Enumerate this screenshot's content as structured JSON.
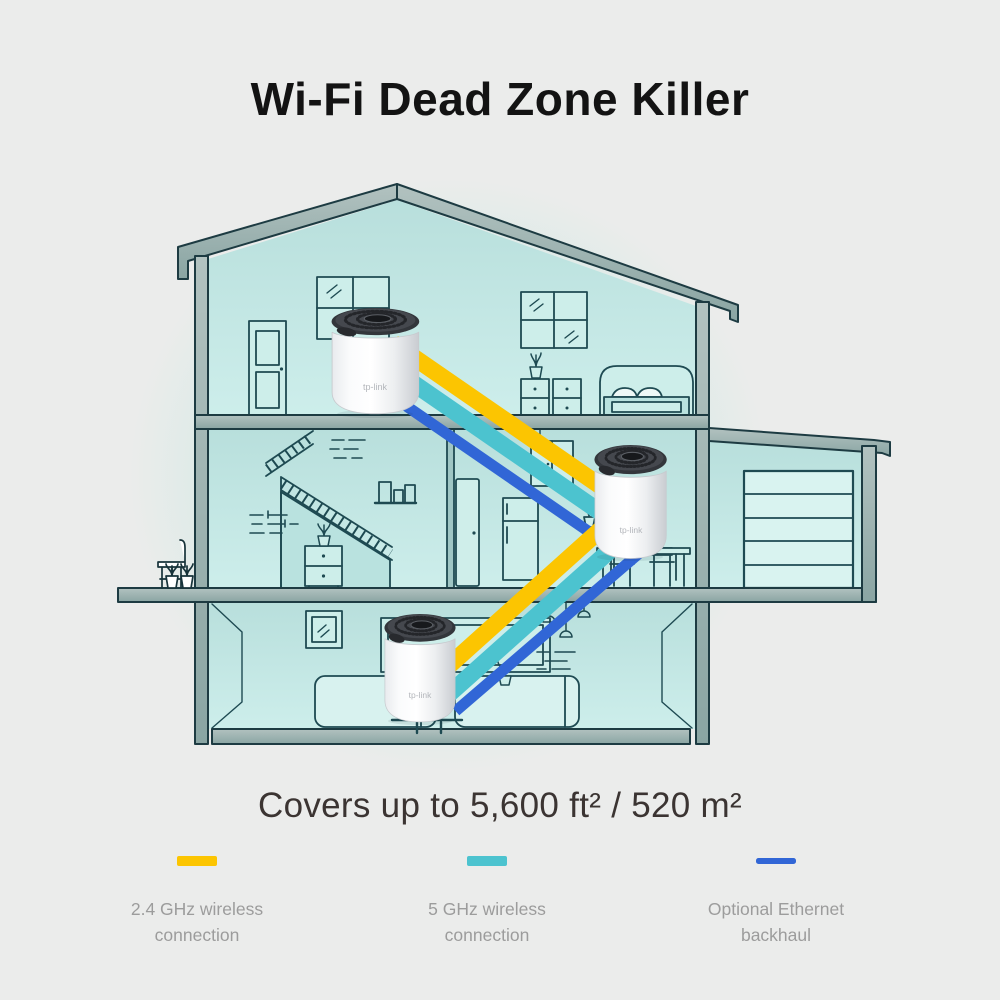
{
  "page": {
    "title": "Wi-Fi Dead Zone Killer",
    "coverage": "Covers up to 5,600 ft² / 520 m²"
  },
  "devices": {
    "brand": "tp-link",
    "count": 3,
    "units": [
      "attic-unit",
      "middle-floor-unit",
      "ground-floor-unit"
    ]
  },
  "legend": [
    {
      "label_line1": "2.4 GHz wireless",
      "label_line2": "connection",
      "color": "#FCC501"
    },
    {
      "label_line1": "5 GHz wireless",
      "label_line2": "connection",
      "color": "#4CC3CF"
    },
    {
      "label_line1": "Optional Ethernet",
      "label_line2": "backhaul",
      "color": "#3166D6"
    }
  ],
  "palette": {
    "page_background": "#ebeceb",
    "house_outline": "#1e4a52",
    "house_fill": "#c3e7e4",
    "beam_fill": "#97aeac",
    "device_body": "#ffffff",
    "device_cap": "#3b3e43"
  }
}
